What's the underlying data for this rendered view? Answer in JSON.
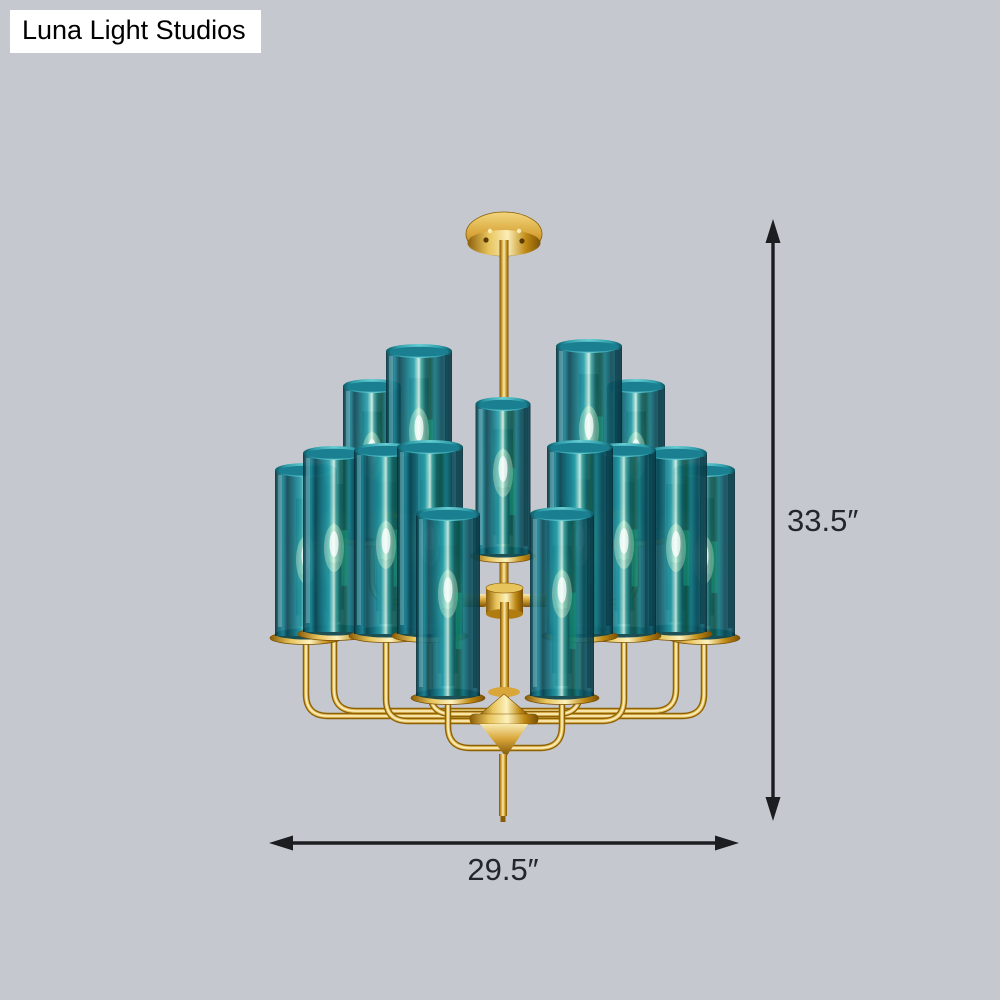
{
  "watermark": {
    "text": "Luna Light Studios"
  },
  "dimensions": {
    "height_label": "33.5″",
    "width_label": "29.5″"
  },
  "scene": {
    "subject": "two-tier chandelier with teal cylinder glass shades and brass frame",
    "light_count": 15,
    "colors": {
      "background": "#c5c8ce",
      "glass_teal": "#16798c",
      "brass_gold": "#d9a63a",
      "dimension_arrows": "#1b1d21",
      "watermark_bg": "#ffffff",
      "watermark_text": "#000000"
    }
  }
}
